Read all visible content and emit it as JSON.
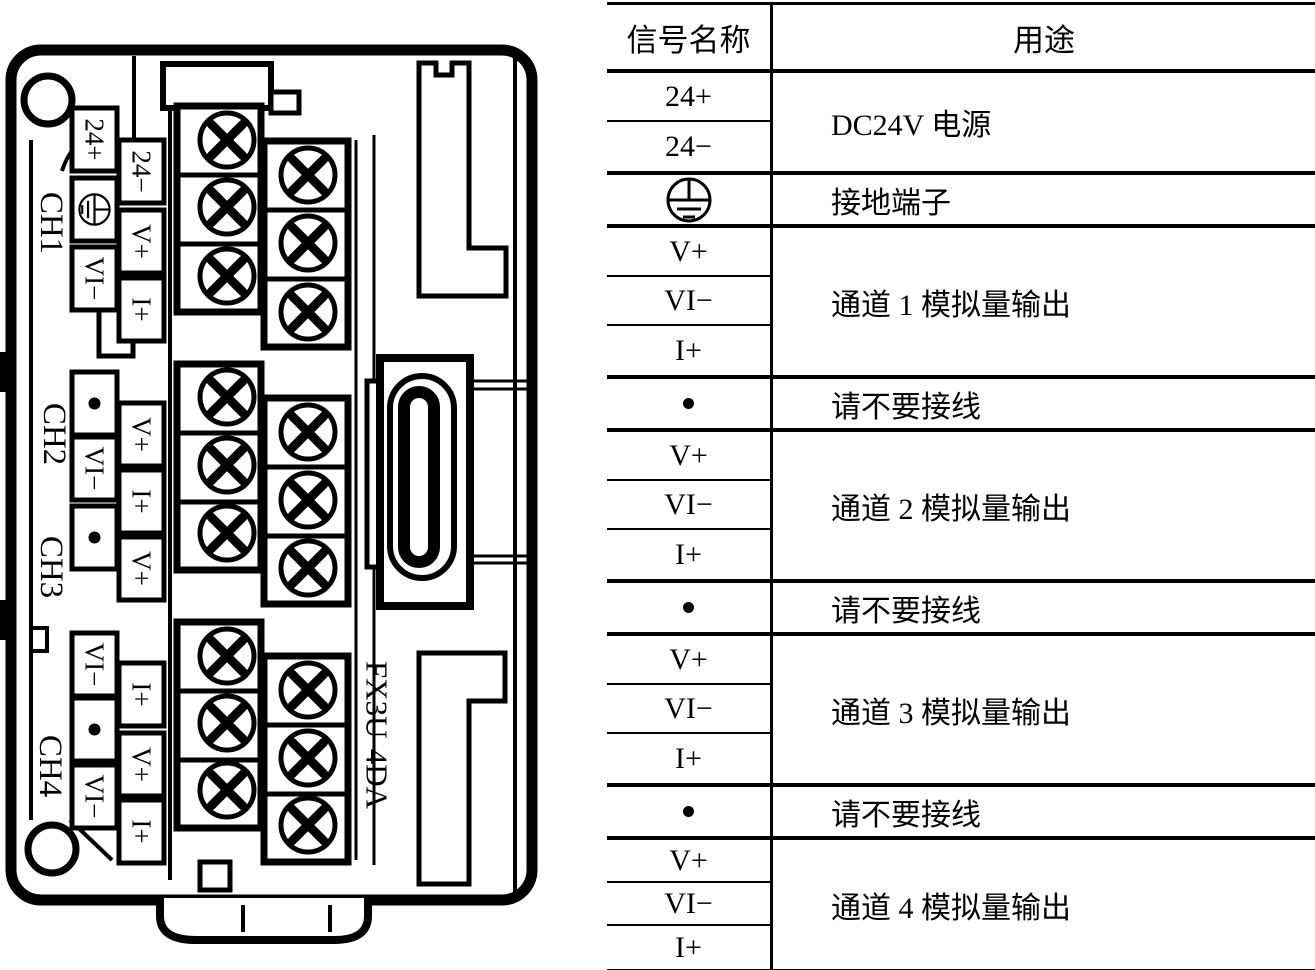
{
  "module": {
    "model": "FX3U-4DA",
    "channel_labels": [
      "CH1",
      "CH2",
      "CH3",
      "CH4"
    ],
    "terminals_col1": [
      "24+",
      "⏚",
      "VI−",
      "•",
      "VI−",
      "•",
      "VI−",
      "•",
      "VI−"
    ],
    "terminals_col2": [
      "24−",
      "V+",
      "I+",
      "V+",
      "I+",
      "V+",
      "I+",
      "V+",
      "I+"
    ]
  },
  "table": {
    "headers": {
      "signal": "信号名称",
      "purpose": "用途"
    },
    "groups": [
      {
        "signals": [
          "24+",
          "24−"
        ],
        "purpose": "DC24V 电源"
      },
      {
        "signals": [
          "⏚"
        ],
        "purpose": "接地端子"
      },
      {
        "signals": [
          "V+",
          "VI−",
          "I+"
        ],
        "purpose": "通道 1 模拟量输出"
      },
      {
        "signals": [
          "•"
        ],
        "purpose": "请不要接线"
      },
      {
        "signals": [
          "V+",
          "VI−",
          "I+"
        ],
        "purpose": "通道 2 模拟量输出"
      },
      {
        "signals": [
          "•"
        ],
        "purpose": "请不要接线"
      },
      {
        "signals": [
          "V+",
          "VI−",
          "I+"
        ],
        "purpose": "通道 3 模拟量输出"
      },
      {
        "signals": [
          "•"
        ],
        "purpose": "请不要接线"
      },
      {
        "signals": [
          "V+",
          "VI−",
          "I+"
        ],
        "purpose": "通道 4 模拟量输出"
      }
    ]
  },
  "colors": {
    "ink": "#000000",
    "paper": "#ffffff"
  }
}
